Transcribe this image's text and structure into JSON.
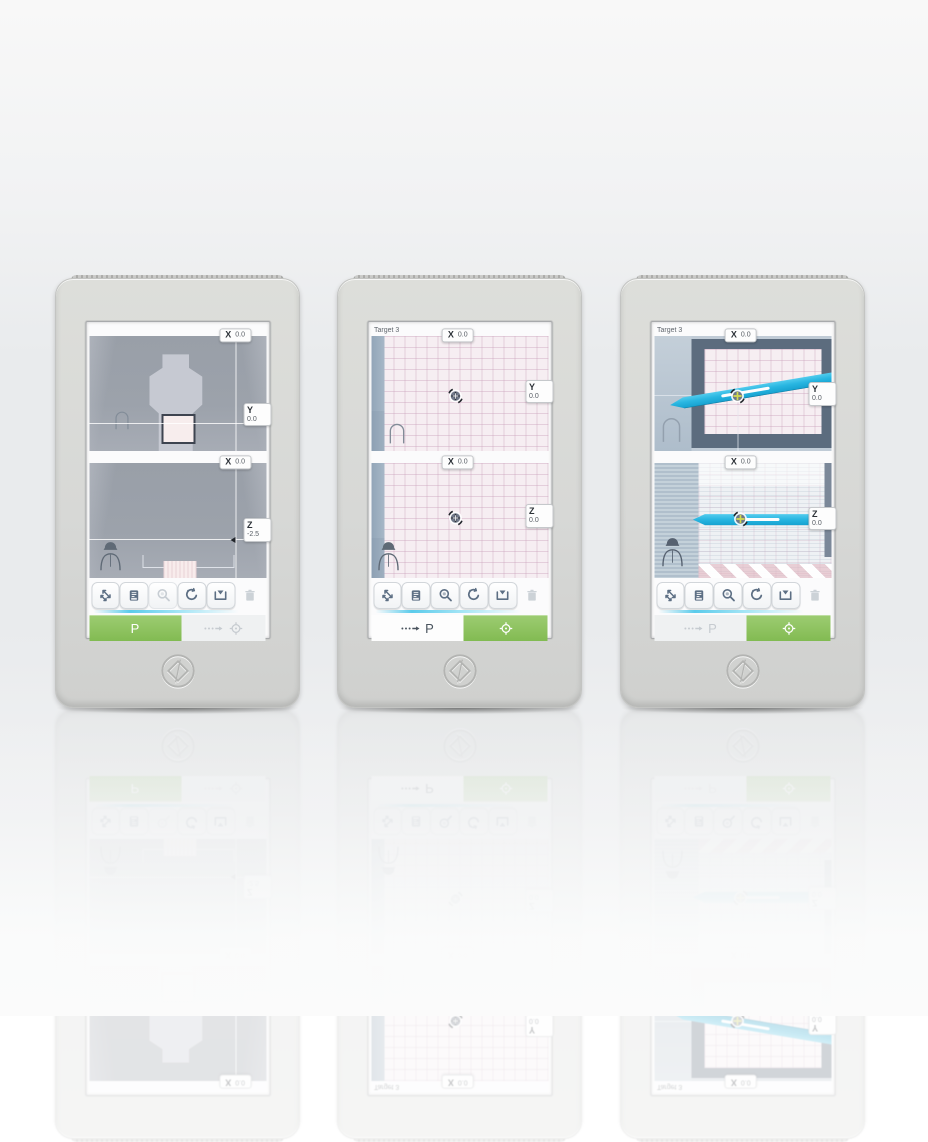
{
  "colors": {
    "accent_green": "#8ec564",
    "needle_cyan": "#29b6e1",
    "accent_line_blue": "#3fc3e8",
    "grid_pink_bg": "#f6eef2",
    "scene_gray": "#9aa0a9"
  },
  "devices": [
    {
      "header_label": "",
      "top_panel": {
        "x_label": "X",
        "x_value": "0.0",
        "side_label": "Y",
        "side_value": "0.0"
      },
      "bottom_panel": {
        "x_label": "X",
        "x_value": "0.0",
        "side_label": "Z",
        "side_value": "-2.5"
      },
      "toolbar": {
        "icons": [
          "measure-icon",
          "report-icon",
          "magnifier-icon",
          "reset-icon",
          "save-icon",
          "trash-icon"
        ]
      },
      "footer": {
        "left_label": "P"
      }
    },
    {
      "header_label": "Target 3",
      "top_panel": {
        "x_label": "X",
        "x_value": "0.0",
        "side_label": "Y",
        "side_value": "0.0"
      },
      "bottom_panel": {
        "x_label": "X",
        "x_value": "0.0",
        "side_label": "Z",
        "side_value": "0.0"
      },
      "toolbar": {
        "icons": [
          "measure-icon",
          "report-icon",
          "magnifier-icon",
          "reset-icon",
          "save-icon",
          "trash-icon"
        ]
      },
      "footer": {
        "left_label": "P"
      }
    },
    {
      "header_label": "Target 3",
      "top_panel": {
        "x_label": "X",
        "x_value": "0.0",
        "side_label": "Y",
        "side_value": "0.0"
      },
      "bottom_panel": {
        "x_label": "X",
        "x_value": "0.0",
        "side_label": "Z",
        "side_value": "0.0"
      },
      "toolbar": {
        "icons": [
          "measure-icon",
          "report-icon",
          "magnifier-icon",
          "reset-icon",
          "save-icon",
          "trash-icon"
        ]
      },
      "footer": {
        "left_label": "P"
      }
    }
  ]
}
